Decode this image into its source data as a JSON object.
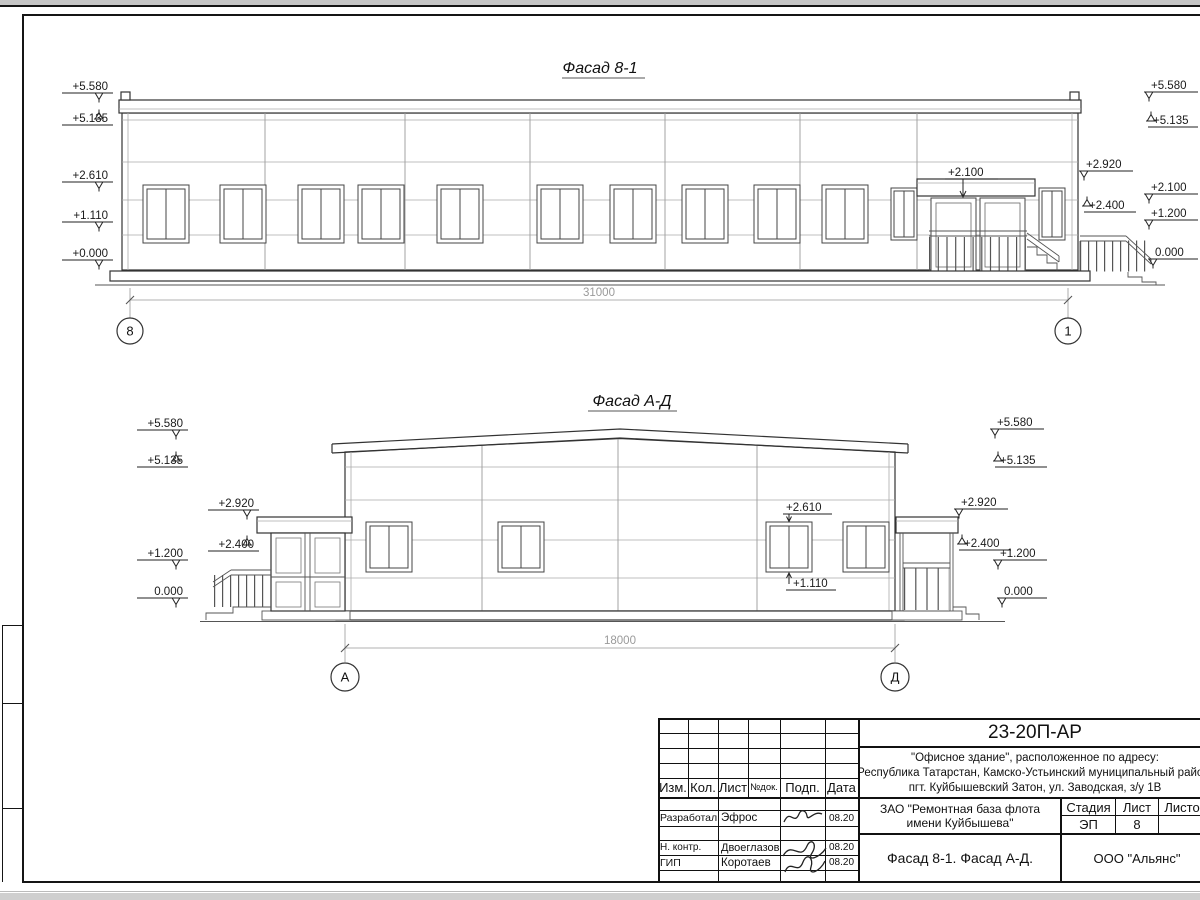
{
  "facade1": {
    "title": "Фасад 8-1",
    "left_marks": [
      "+5.580",
      "+5.135",
      "+2.610",
      "+1.110",
      "+0.000"
    ],
    "right_marks": [
      "+5.580",
      "+5.135",
      "+2.920",
      "+2.100",
      "+2.400",
      "+1.200",
      "0.000"
    ],
    "entrance_mark": "+2.100",
    "dimension": "31000",
    "axis_left": "8",
    "axis_right": "1"
  },
  "facade2": {
    "title": "Фасад А-Д",
    "left_marks": [
      "+5.580",
      "+5.135",
      "+2.920",
      "+2.400",
      "+1.200",
      "0.000"
    ],
    "right_marks": [
      "+5.580",
      "+5.135",
      "+2.920",
      "+2.400",
      "+1.200",
      "0.000"
    ],
    "window_top_mark": "+2.610",
    "window_bottom_mark": "+1.110",
    "dimension": "18000",
    "axis_left": "А",
    "axis_right": "Д"
  },
  "title_block": {
    "doc_number": "23-20П-АР",
    "object_address": [
      "\"Офисное здание\", расположенное по адресу:",
      "Республика Татарстан, Камско-Устьинский муниципальный район,",
      "пгт. Куйбышевский Затон, ул. Заводская, з/у 1В"
    ],
    "client": [
      "ЗАО \"Ремонтная база флота",
      "имени Куйбышева\""
    ],
    "sheet_title": "Фасад 8-1. Фасад А-Д.",
    "company": "ООО \"Альянс\"",
    "stage_label": "Стадия",
    "list_label": "Лист",
    "listov_label": "Листов",
    "stage_value": "ЭП",
    "list_value": "8",
    "columns": {
      "izm": "Изм.",
      "kol": "Кол.",
      "list": "Лист",
      "ndok": "№док.",
      "podp": "Подп.",
      "data": "Дата"
    },
    "signers": [
      {
        "role": "Разработал",
        "name": "Эфрос",
        "date": "08.20"
      },
      {
        "role": "Н. контр.",
        "name": "Двоеглазов",
        "date": "08.20"
      },
      {
        "role": "ГИП",
        "name": "Коротаев",
        "date": "08.20"
      }
    ]
  }
}
